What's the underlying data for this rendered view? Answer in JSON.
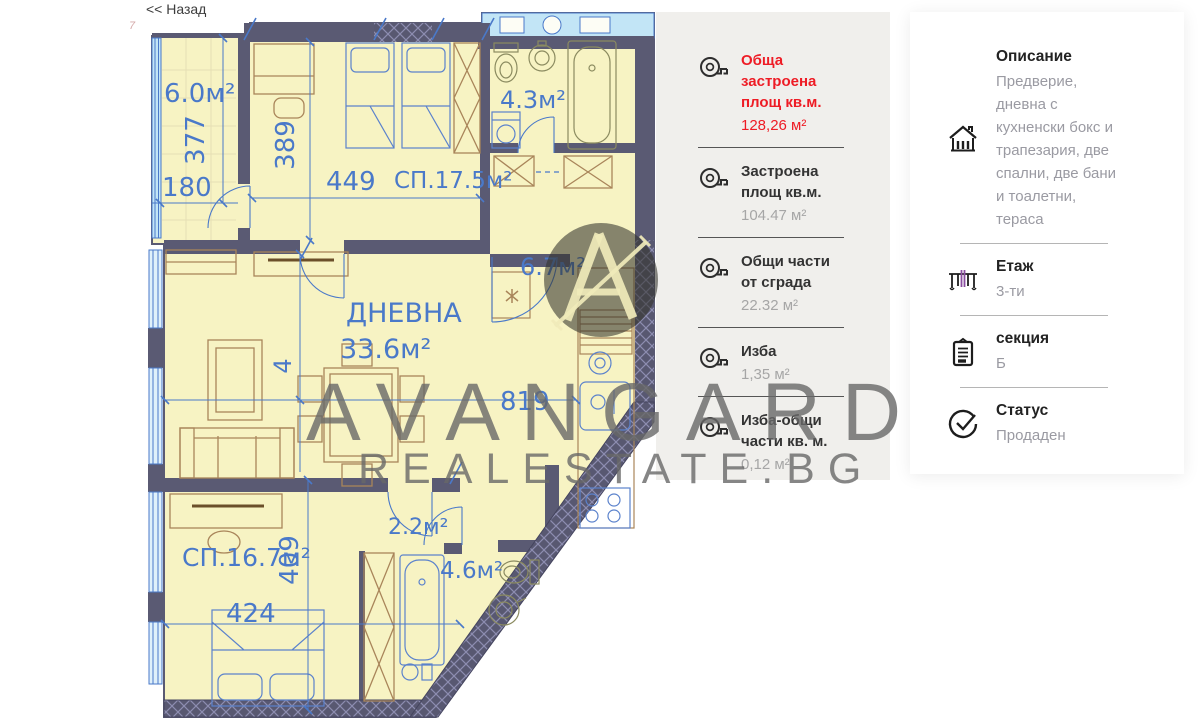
{
  "page": {
    "back_link": "<< Назад"
  },
  "floor_plan": {
    "labels": {
      "terrace": "6.0м²",
      "bedroom1": "СП.17.5м²",
      "bedroom1_dim": "449",
      "bath1": "4.3м²",
      "hall": "6.7м²",
      "living_title": "ДНЕВНА",
      "living_area": "33.6м²",
      "kitchen_dim": "819",
      "corridor": "2.2м²",
      "bath2": "4.6м²",
      "bedroom2": "СП.16.7м²",
      "dim_377": "377",
      "dim_180": "180",
      "dim_389": "389",
      "dim_4": "4",
      "dim_409": "409",
      "dim_424": "424",
      "dim_edge": "7"
    },
    "colors": {
      "wall": "#5a5a73",
      "room_fill": "#f7f3c3",
      "window_blue": "#c2e5f6",
      "line_blue": "#4a79c9",
      "furniture_brown": "#a9855a"
    }
  },
  "measurements_panel": {
    "items": [
      {
        "label": "Обща застроена площ кв.м.",
        "value": "128,26 м²",
        "icon": "tape-measure-icon",
        "highlight": true
      },
      {
        "label": "Застроена площ кв.м.",
        "value": "104.47 м²",
        "icon": "tape-measure-icon",
        "highlight": false
      },
      {
        "label": "Общи части от сграда",
        "value": "22.32 м²",
        "icon": "tape-measure-icon",
        "highlight": false
      },
      {
        "label": "Изба",
        "value": "1,35 м²",
        "icon": "tape-measure-icon",
        "highlight": false
      },
      {
        "label": "Изба-общи части кв. м.",
        "value": "0,12 м²",
        "icon": "tape-measure-icon",
        "highlight": false
      }
    ],
    "accent_color": "#ee1c25"
  },
  "details_panel": {
    "items": [
      {
        "label": "Описание",
        "value": "Предверие, дневна с кухненски бокс и трапезария, две спални, две бани и тоалетни, тераса",
        "icon": "house-icon"
      },
      {
        "label": "Етаж",
        "value": "3-ти",
        "icon": "floors-icon"
      },
      {
        "label": "секция",
        "value": "Б",
        "icon": "clipboard-icon"
      },
      {
        "label": "Статус",
        "value": "Продаден",
        "icon": "check-circle-icon"
      }
    ]
  },
  "watermark": {
    "line1": "AVANGARD",
    "line2": "REALESTATE.BG",
    "logo": "avangard-logo"
  }
}
